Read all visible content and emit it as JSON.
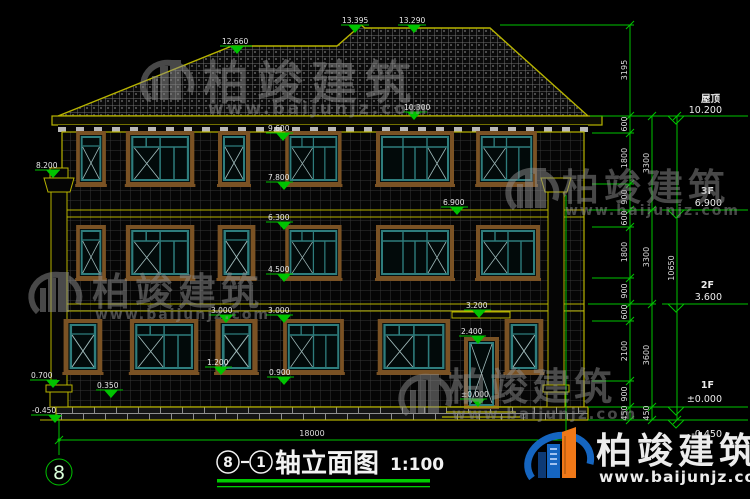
{
  "drawing": {
    "title": "轴立面图",
    "scale": "1:100",
    "axis_start": "8",
    "axis_end": "1",
    "axis_bubble": "8",
    "bottom_dimension": "18000"
  },
  "elevation_markers": {
    "left_ridge": "12.660",
    "peak": "13.395",
    "ridge": "13.290",
    "eave_low": "10.300",
    "pilaster_top": "8.200",
    "f3_head": "9.600",
    "f3_sill": "7.800",
    "f3_floor": "6.900",
    "f3_band": "6.300",
    "f2_sill": "4.500",
    "f1_head_left": "3.000",
    "f1_head_right": "3.000",
    "porch_top": "3.200",
    "door_head": "2.400",
    "f1_sill_left": "1.200",
    "f1_sill_right": "0.900",
    "door_zero": "±0.000",
    "gate_cap": "0.700",
    "plinth_top": "0.350",
    "ground_left": "-0.450"
  },
  "right_dims": {
    "chain_a": [
      "3195",
      "600",
      "1800",
      "900",
      "600",
      "1800",
      "900",
      "600",
      "2100",
      "900",
      "450"
    ],
    "chain_b": [
      "3300",
      "3300",
      "3600",
      "450"
    ],
    "chain_c": [
      "10650"
    ]
  },
  "levels": {
    "roof_name": "屋顶",
    "roof_value": "10.200",
    "f3_name": "3F",
    "f3_value": "6.900",
    "f2_name": "2F",
    "f2_value": "3.600",
    "f1_name": "1F",
    "f1_value": "±0.000",
    "base_value": "-0.450"
  },
  "watermark": {
    "brand": "柏竣建筑",
    "url": "www.baijunjz.com"
  },
  "logo": {
    "brand": "柏竣建筑",
    "url": "www.baijunjz.com"
  }
}
